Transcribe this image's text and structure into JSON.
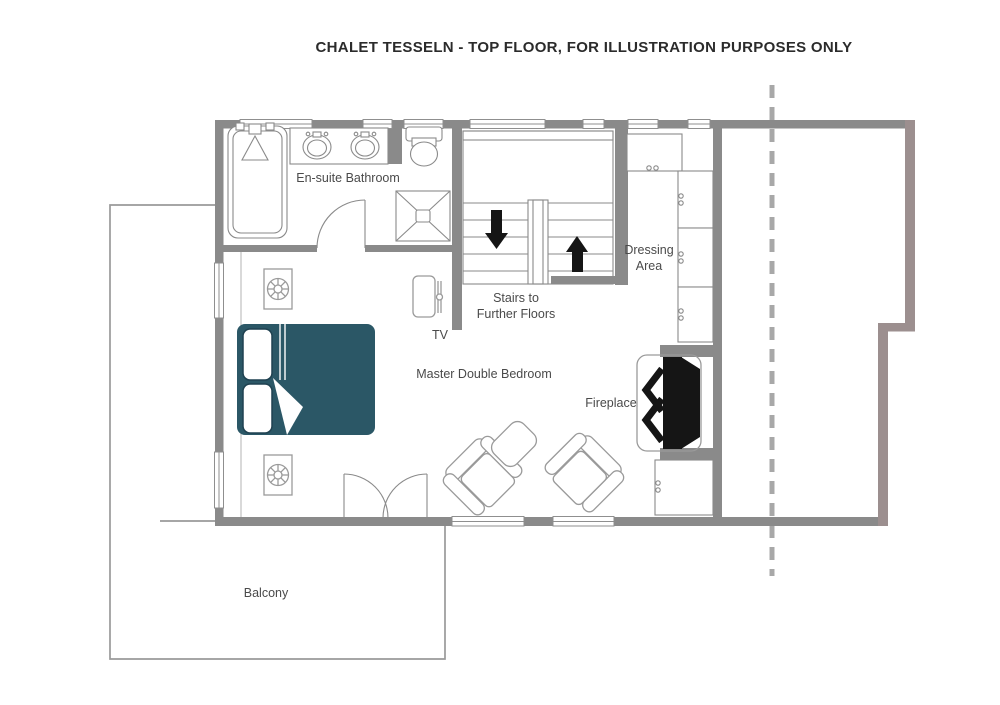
{
  "title": "CHALET TESSELN - TOP FLOOR, FOR ILLUSTRATION PURPOSES ONLY",
  "labels": {
    "bathroom": "En-suite Bathroom",
    "stairs_line1": "Stairs to",
    "stairs_line2": "Further Floors",
    "dressing_line1": "Dressing",
    "dressing_line2": "Area",
    "bedroom": "Master Double Bedroom",
    "fireplace": "Fireplace",
    "tv": "TV",
    "balcony": "Balcony"
  },
  "colors": {
    "wall": "#8a8a8a",
    "wall_accent": "#9c8f8f",
    "line": "#9a9a9a",
    "bed": "#2b5766",
    "bed_dark": "#1f4150",
    "black": "#151515",
    "dashed_line": "#a8a8a8",
    "text": "#4a4a4a",
    "title_text": "#2b2b2b",
    "background": "#ffffff"
  }
}
